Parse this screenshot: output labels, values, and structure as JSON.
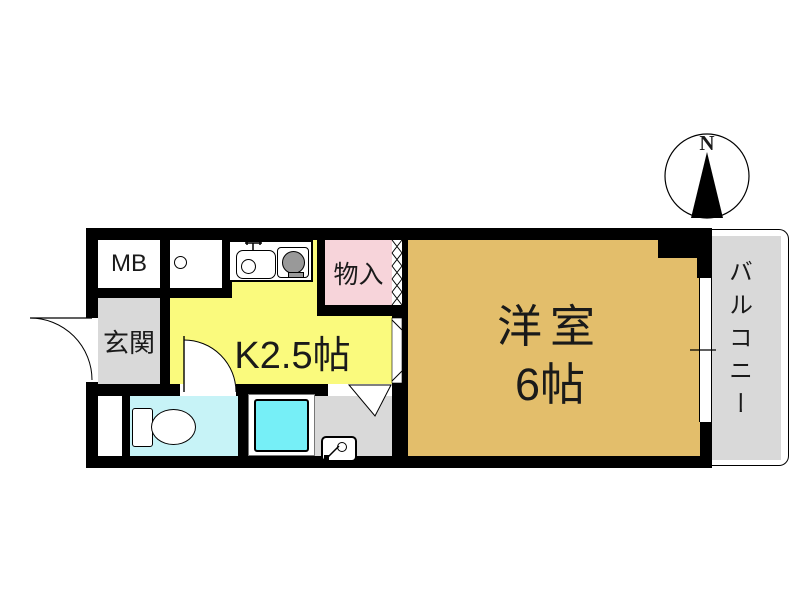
{
  "title": "1K apartment floor plan",
  "compass": {
    "north_label": "N"
  },
  "rooms": {
    "mb": {
      "label": "MB"
    },
    "genkan": {
      "label": "玄関"
    },
    "kitchen": {
      "label": "K2.5帖",
      "size_tatami": 2.5
    },
    "storage": {
      "label": "物入"
    },
    "western_room": {
      "label_line1": "洋室",
      "label_line2": "6帖",
      "size_tatami": 6
    },
    "balcony": {
      "label": "バルコニー"
    }
  },
  "icons": {
    "sink": "kitchen-sink-icon",
    "stove": "stove-burner-icon",
    "toilet": "toilet-icon",
    "bathtub": "bathtub-icon",
    "washer": "washing-machine-icon",
    "doors": "door-swing-arc-icon",
    "closet_door": "folding-door-zigzag-icon",
    "compass": "north-arrow-icon"
  },
  "colors": {
    "wall": "#000000",
    "tan": "#e3be6b",
    "yellow": "#fafa7d",
    "pink": "#f7d4da",
    "gray": "#d9d9d9",
    "cyanpale": "#c7f3f7",
    "cyanbright": "#76eff7",
    "burner": "#999999",
    "white": "#ffffff"
  }
}
